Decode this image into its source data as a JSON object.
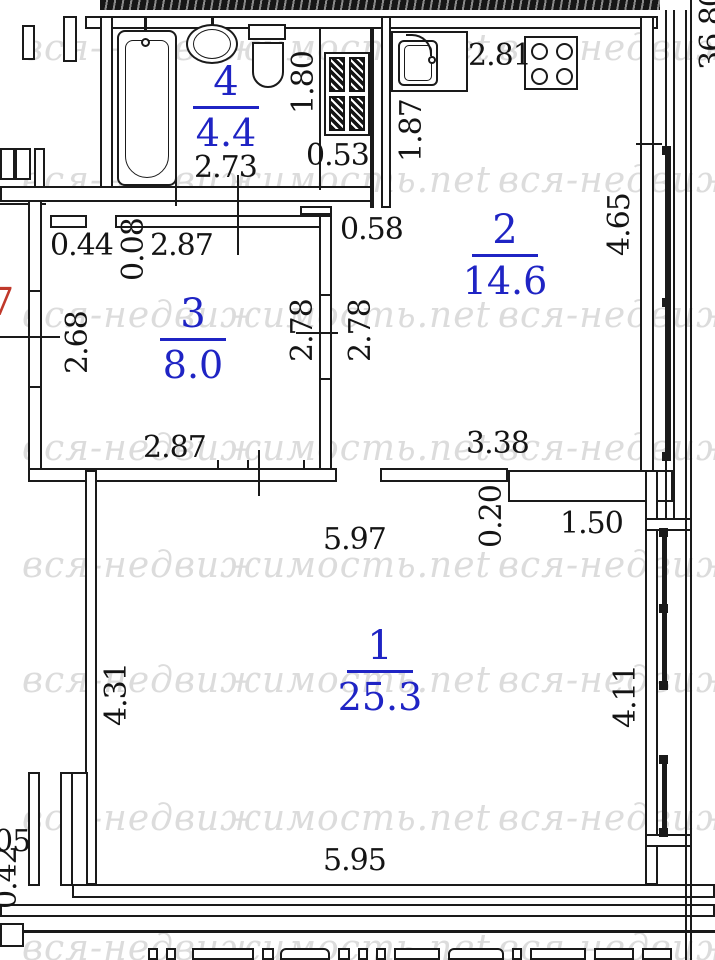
{
  "watermark": {
    "text": "вся-недвижимость.net"
  },
  "rooms": [
    {
      "number": "1",
      "area": "25.3"
    },
    {
      "number": "2",
      "area": "14.6"
    },
    {
      "number": "3",
      "area": "8.0"
    },
    {
      "number": "4",
      "area": "4.4"
    }
  ],
  "dimensions": {
    "kitchen_top_width": "2.81",
    "shaft_height": "1.80",
    "shaft_width": "0.53",
    "kitchen_left_height": "1.87",
    "bath_width": "2.73",
    "kitchen_door_offset": "0.58",
    "kitchen_right_height": "4.65",
    "room3_nook_width": "0.44",
    "room3_wall_jog": "0.08",
    "room3_top_width": "2.87",
    "room3_left_height": "2.68",
    "room3_right_height": "2.78",
    "hall_height": "2.78",
    "room3_bottom_width": "2.87",
    "kitchen_bottom_width": "3.38",
    "ledge_depth": "0.20",
    "ledge_width": "1.50",
    "room1_top_width": "5.97",
    "room1_left_height": "4.31",
    "room1_right_height": "4.11",
    "room1_bottom_width": "5.95",
    "left_edge_cut": "05",
    "left_edge_depth": "0.42"
  },
  "marks": {
    "unit_number": "7",
    "total_area_side": "36.80"
  },
  "colors": {
    "room_label": "#1f24c4",
    "dimension_text": "#141414",
    "unit_number_red": "#c0392b",
    "watermark_gray": "#dcdcdc",
    "wall_black": "#1a1a1a"
  }
}
